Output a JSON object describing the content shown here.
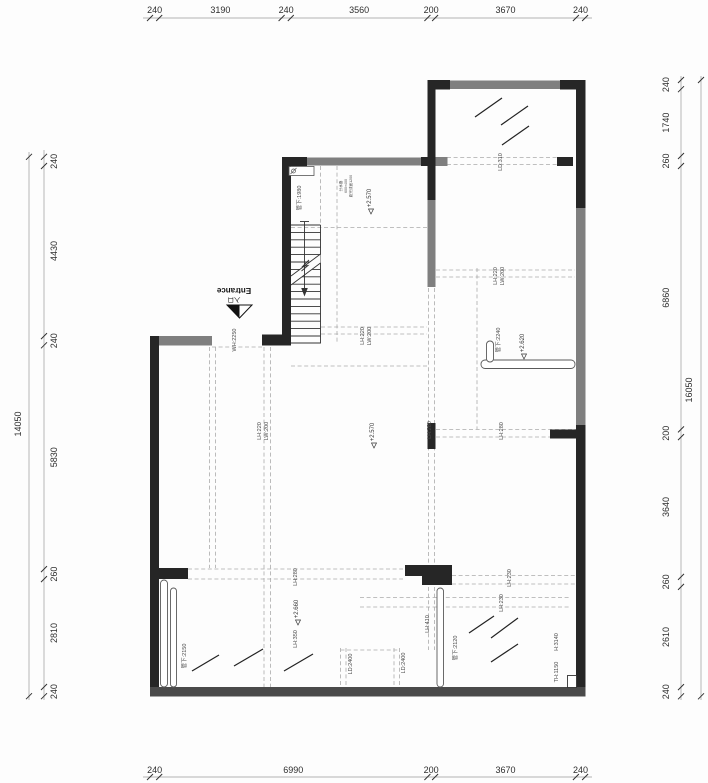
{
  "colors": {
    "wall": "#262626",
    "wall_outer": "#4a4a4a",
    "window": "#7f7f7f",
    "window_light": "#8a8a8a",
    "dash": "#ababab"
  },
  "dims": {
    "top": [
      "240",
      "3190",
      "240",
      "3560",
      "200",
      "3670",
      "240"
    ],
    "bottom": [
      "240",
      "6990",
      "200",
      "3670",
      "240"
    ],
    "left": [
      "240",
      "4430",
      "240",
      "5830",
      "260",
      "2810",
      "240"
    ],
    "left_total": "14050",
    "right": [
      "240",
      "1740",
      "260",
      "6860",
      "200",
      "3640",
      "260",
      "2610",
      "240"
    ],
    "right_total": "16050"
  },
  "entrance": {
    "en": "Entrance",
    "zh": "入口",
    "opening_height": "WH:2250"
  },
  "levels": {
    "stair_hall": "+2.570",
    "main_hall": "+2.570",
    "right_wing": "+2.620",
    "lower_hall": "+2.660"
  },
  "beams": {
    "ld310": "LD:310",
    "stair_lh": "LH:220",
    "stair_lw": "LW:200",
    "hall_lh": "LH:220",
    "hall_lw": "LW:200",
    "right_lh": "LH:220",
    "right_lw": "LW:200",
    "mid_lh_a": "LH:280",
    "mid_lh_b": "LH:280",
    "low_left_lh": "LH:280",
    "low_left_lh2": "LH:350",
    "low_right_lh_a": "LH:230",
    "low_right_lh_b": "LH:230",
    "lh410": "LH:410",
    "ld2400_a": "LD:2400",
    "ld2400_b": "LD:2400"
  },
  "pipes": {
    "stair": "管下:1980",
    "rail": "管下:2240",
    "left": "管下:2150",
    "mid": "管下:2120"
  },
  "heights": {
    "h": "H:3140",
    "th": "TH:1150"
  },
  "manifold": {
    "l1": "分水器",
    "l2": "600×400",
    "l3": "距完成面1200"
  }
}
